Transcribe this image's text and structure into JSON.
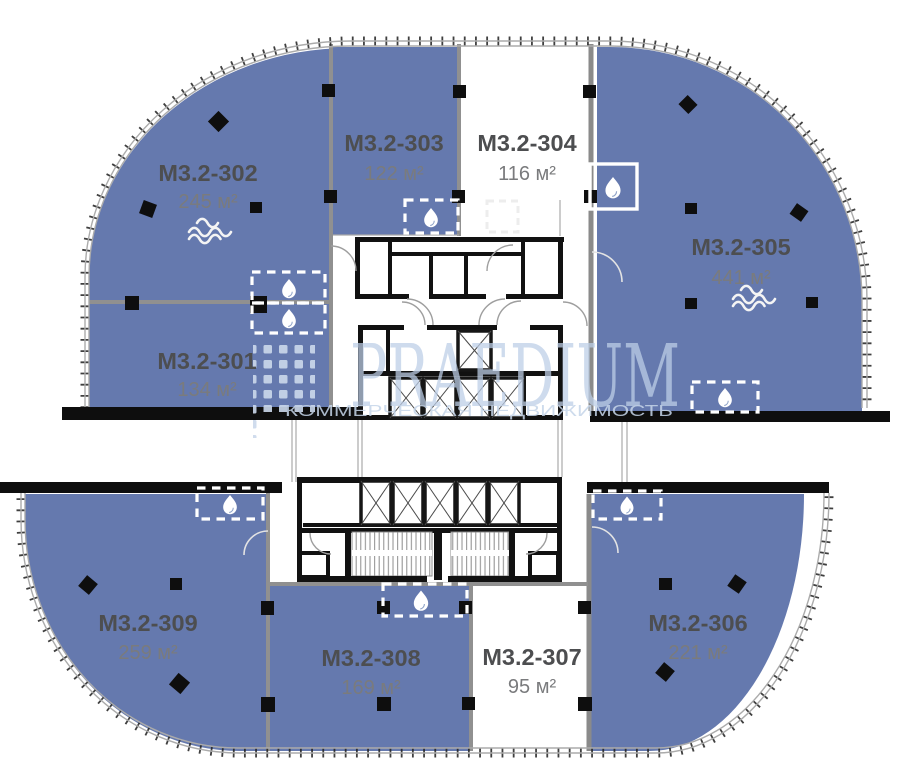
{
  "watermark": {
    "brand": "PRAEDIUM",
    "subtitle": "КОММЕРЧЕСКАЯ НЕДВИЖИМОСТЬ"
  },
  "units": [
    {
      "label": "M3.2-301",
      "area": "134 м²",
      "status": "available"
    },
    {
      "label": "M3.2-302",
      "area": "245 м²",
      "status": "available",
      "feature": "water-waves"
    },
    {
      "label": "M3.2-303",
      "area": "122 м²",
      "status": "available"
    },
    {
      "label": "M3.2-304",
      "area": "116 м²",
      "status": "unavailable"
    },
    {
      "label": "M3.2-305",
      "area": "441 м²",
      "status": "available",
      "feature": "water-waves"
    },
    {
      "label": "M3.2-306",
      "area": "221 м²",
      "status": "available"
    },
    {
      "label": "M3.2-307",
      "area": "95 м²",
      "status": "unavailable"
    },
    {
      "label": "M3.2-308",
      "area": "169 м²",
      "status": "available"
    },
    {
      "label": "M3.2-309",
      "area": "259 м²",
      "status": "available"
    }
  ],
  "colors": {
    "unit_available": "#6579ae",
    "unit_unavailable": "#ffffff",
    "unit_label_text": "#4d4e50",
    "unit_area_text": "#7a7b7d",
    "watermark": "#c3d3e8",
    "wall_gray": "#909090",
    "structure_black": "#0e0e0e"
  },
  "core": {
    "elevators_upper_bank": 4,
    "elevator_service": 1,
    "elevators_lower_bank": 5,
    "stairwells": 2,
    "wet_point_badges": 8
  }
}
